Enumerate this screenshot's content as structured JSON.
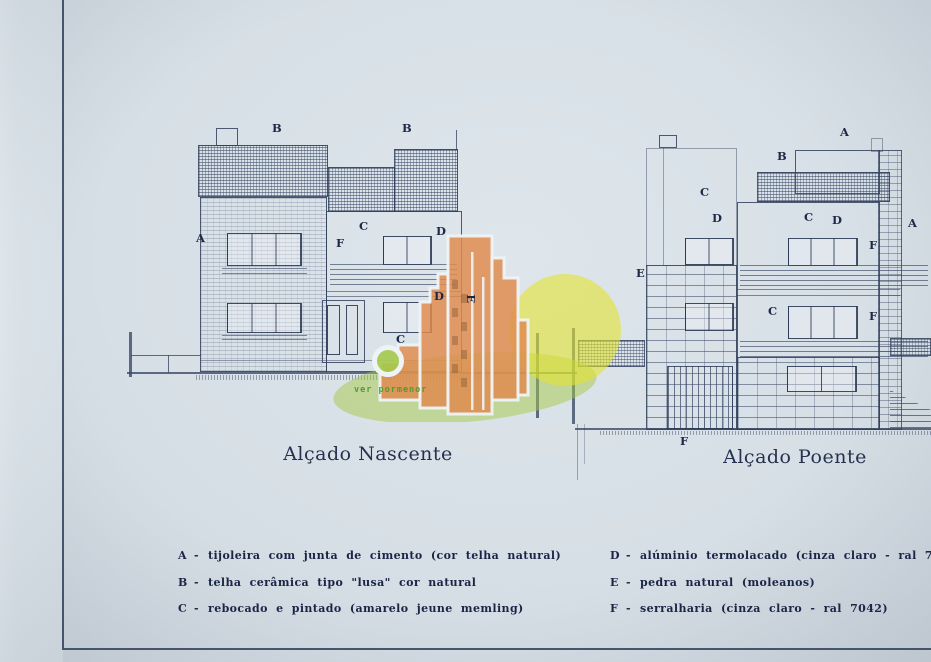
{
  "titles": {
    "left": "Alçado Nascente",
    "right": "Alçado Poente"
  },
  "legend": {
    "left": [
      {
        "key": "A",
        "dash": "-",
        "text": "tijoleira com junta de cimento (cor telha natural)"
      },
      {
        "key": "B",
        "dash": "-",
        "text": "telha cerâmica tipo \"lusa\" cor natural"
      },
      {
        "key": "C",
        "dash": "-",
        "text": "rebocado e pintado (amarelo jeune memling)"
      }
    ],
    "right": [
      {
        "key": "D",
        "dash": "-",
        "text": "alúminio termolacado (cinza claro - ral 7042)"
      },
      {
        "key": "E",
        "dash": "-",
        "text": "pedra natural (moleanos)"
      },
      {
        "key": "F",
        "dash": "-",
        "text": "serralharia (cinza claro - ral 7042)"
      }
    ]
  },
  "nascente_labels": [
    {
      "t": "B",
      "x": 272,
      "y": 123
    },
    {
      "t": "B",
      "x": 402,
      "y": 123
    },
    {
      "t": "A",
      "x": 196,
      "y": 233
    },
    {
      "t": "C",
      "x": 359,
      "y": 221
    },
    {
      "t": "F",
      "x": 336,
      "y": 238
    },
    {
      "t": "D",
      "x": 436,
      "y": 226
    },
    {
      "t": "D",
      "x": 434,
      "y": 291
    },
    {
      "t": "C",
      "x": 396,
      "y": 334
    },
    {
      "t": "E",
      "x": 466,
      "y": 293,
      "rot": 90
    }
  ],
  "poente_labels": [
    {
      "t": "A",
      "x": 840,
      "y": 127
    },
    {
      "t": "B",
      "x": 777,
      "y": 151
    },
    {
      "t": "C",
      "x": 700,
      "y": 187
    },
    {
      "t": "D",
      "x": 712,
      "y": 213
    },
    {
      "t": "C",
      "x": 804,
      "y": 212
    },
    {
      "t": "D",
      "x": 832,
      "y": 215
    },
    {
      "t": "A",
      "x": 908,
      "y": 218
    },
    {
      "t": "E",
      "x": 636,
      "y": 268
    },
    {
      "t": "F",
      "x": 869,
      "y": 240
    },
    {
      "t": "C",
      "x": 768,
      "y": 306
    },
    {
      "t": "F",
      "x": 869,
      "y": 311
    },
    {
      "t": "F",
      "x": 680,
      "y": 436
    }
  ],
  "watermark": {
    "caption": "ver pormenor",
    "colors": {
      "orange": "#e08c4f",
      "yellow": "#e2e22e",
      "green": "#a6c848",
      "caption_green": "#4f9a2e"
    }
  }
}
